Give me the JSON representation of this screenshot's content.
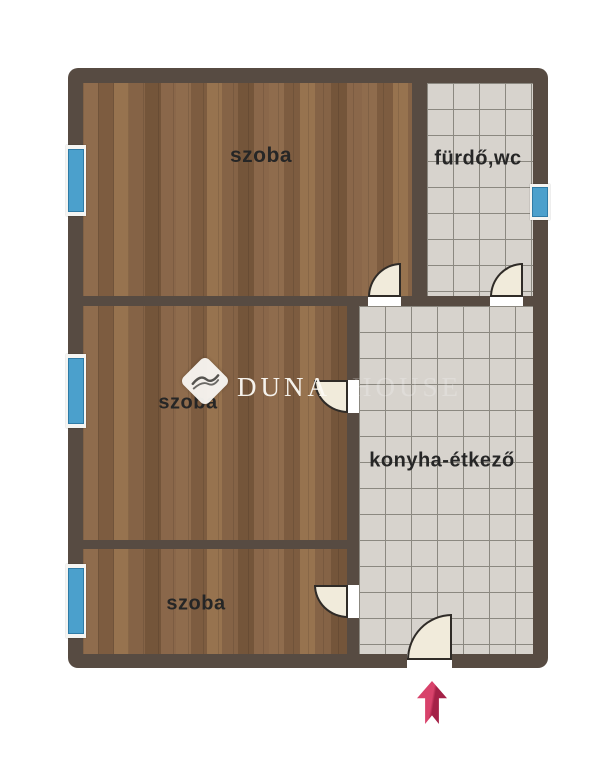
{
  "floor_plan": {
    "rooms": [
      {
        "id": "szoba-top",
        "label": "szoba",
        "floor": "wood"
      },
      {
        "id": "furdo-wc",
        "label": "fürdő,wc",
        "floor": "tile"
      },
      {
        "id": "szoba-middle",
        "label": "szoba",
        "floor": "wood"
      },
      {
        "id": "konyha-etkezo",
        "label": "konyha-étkező",
        "floor": "tile"
      },
      {
        "id": "szoba-bottom",
        "label": "szoba",
        "floor": "wood"
      }
    ],
    "watermark": {
      "primary": "DUNA",
      "secondary": "HOUSE"
    },
    "windows": [
      {
        "id": "window-szoba-top",
        "wall": "left"
      },
      {
        "id": "window-szoba-middle",
        "wall": "left"
      },
      {
        "id": "window-szoba-bottom",
        "wall": "left"
      },
      {
        "id": "window-furdo",
        "wall": "right"
      }
    ],
    "doors": [
      {
        "id": "door-szoba-top",
        "between": "konyha-étkező / szoba (top)"
      },
      {
        "id": "door-furdo",
        "between": "konyha-étkező / fürdő,wc"
      },
      {
        "id": "door-szoba-middle",
        "between": "konyha-étkező / szoba (middle)"
      },
      {
        "id": "door-szoba-bottom",
        "between": "konyha-étkező / szoba (bottom)"
      },
      {
        "id": "door-entrance",
        "between": "outside / konyha-étkező"
      }
    ],
    "entrance_arrow": {
      "direction": "up",
      "color": "#c62a52"
    },
    "colors": {
      "wall": "#574b42",
      "wood_floor": "#8a674a",
      "tile_floor": "#d7d3cd",
      "tile_grout": "#8b8880",
      "window_blue": "#4ba0cc",
      "door_fill": "#f1ebdb",
      "label_text": "#262626",
      "background": "#ffffff"
    }
  }
}
